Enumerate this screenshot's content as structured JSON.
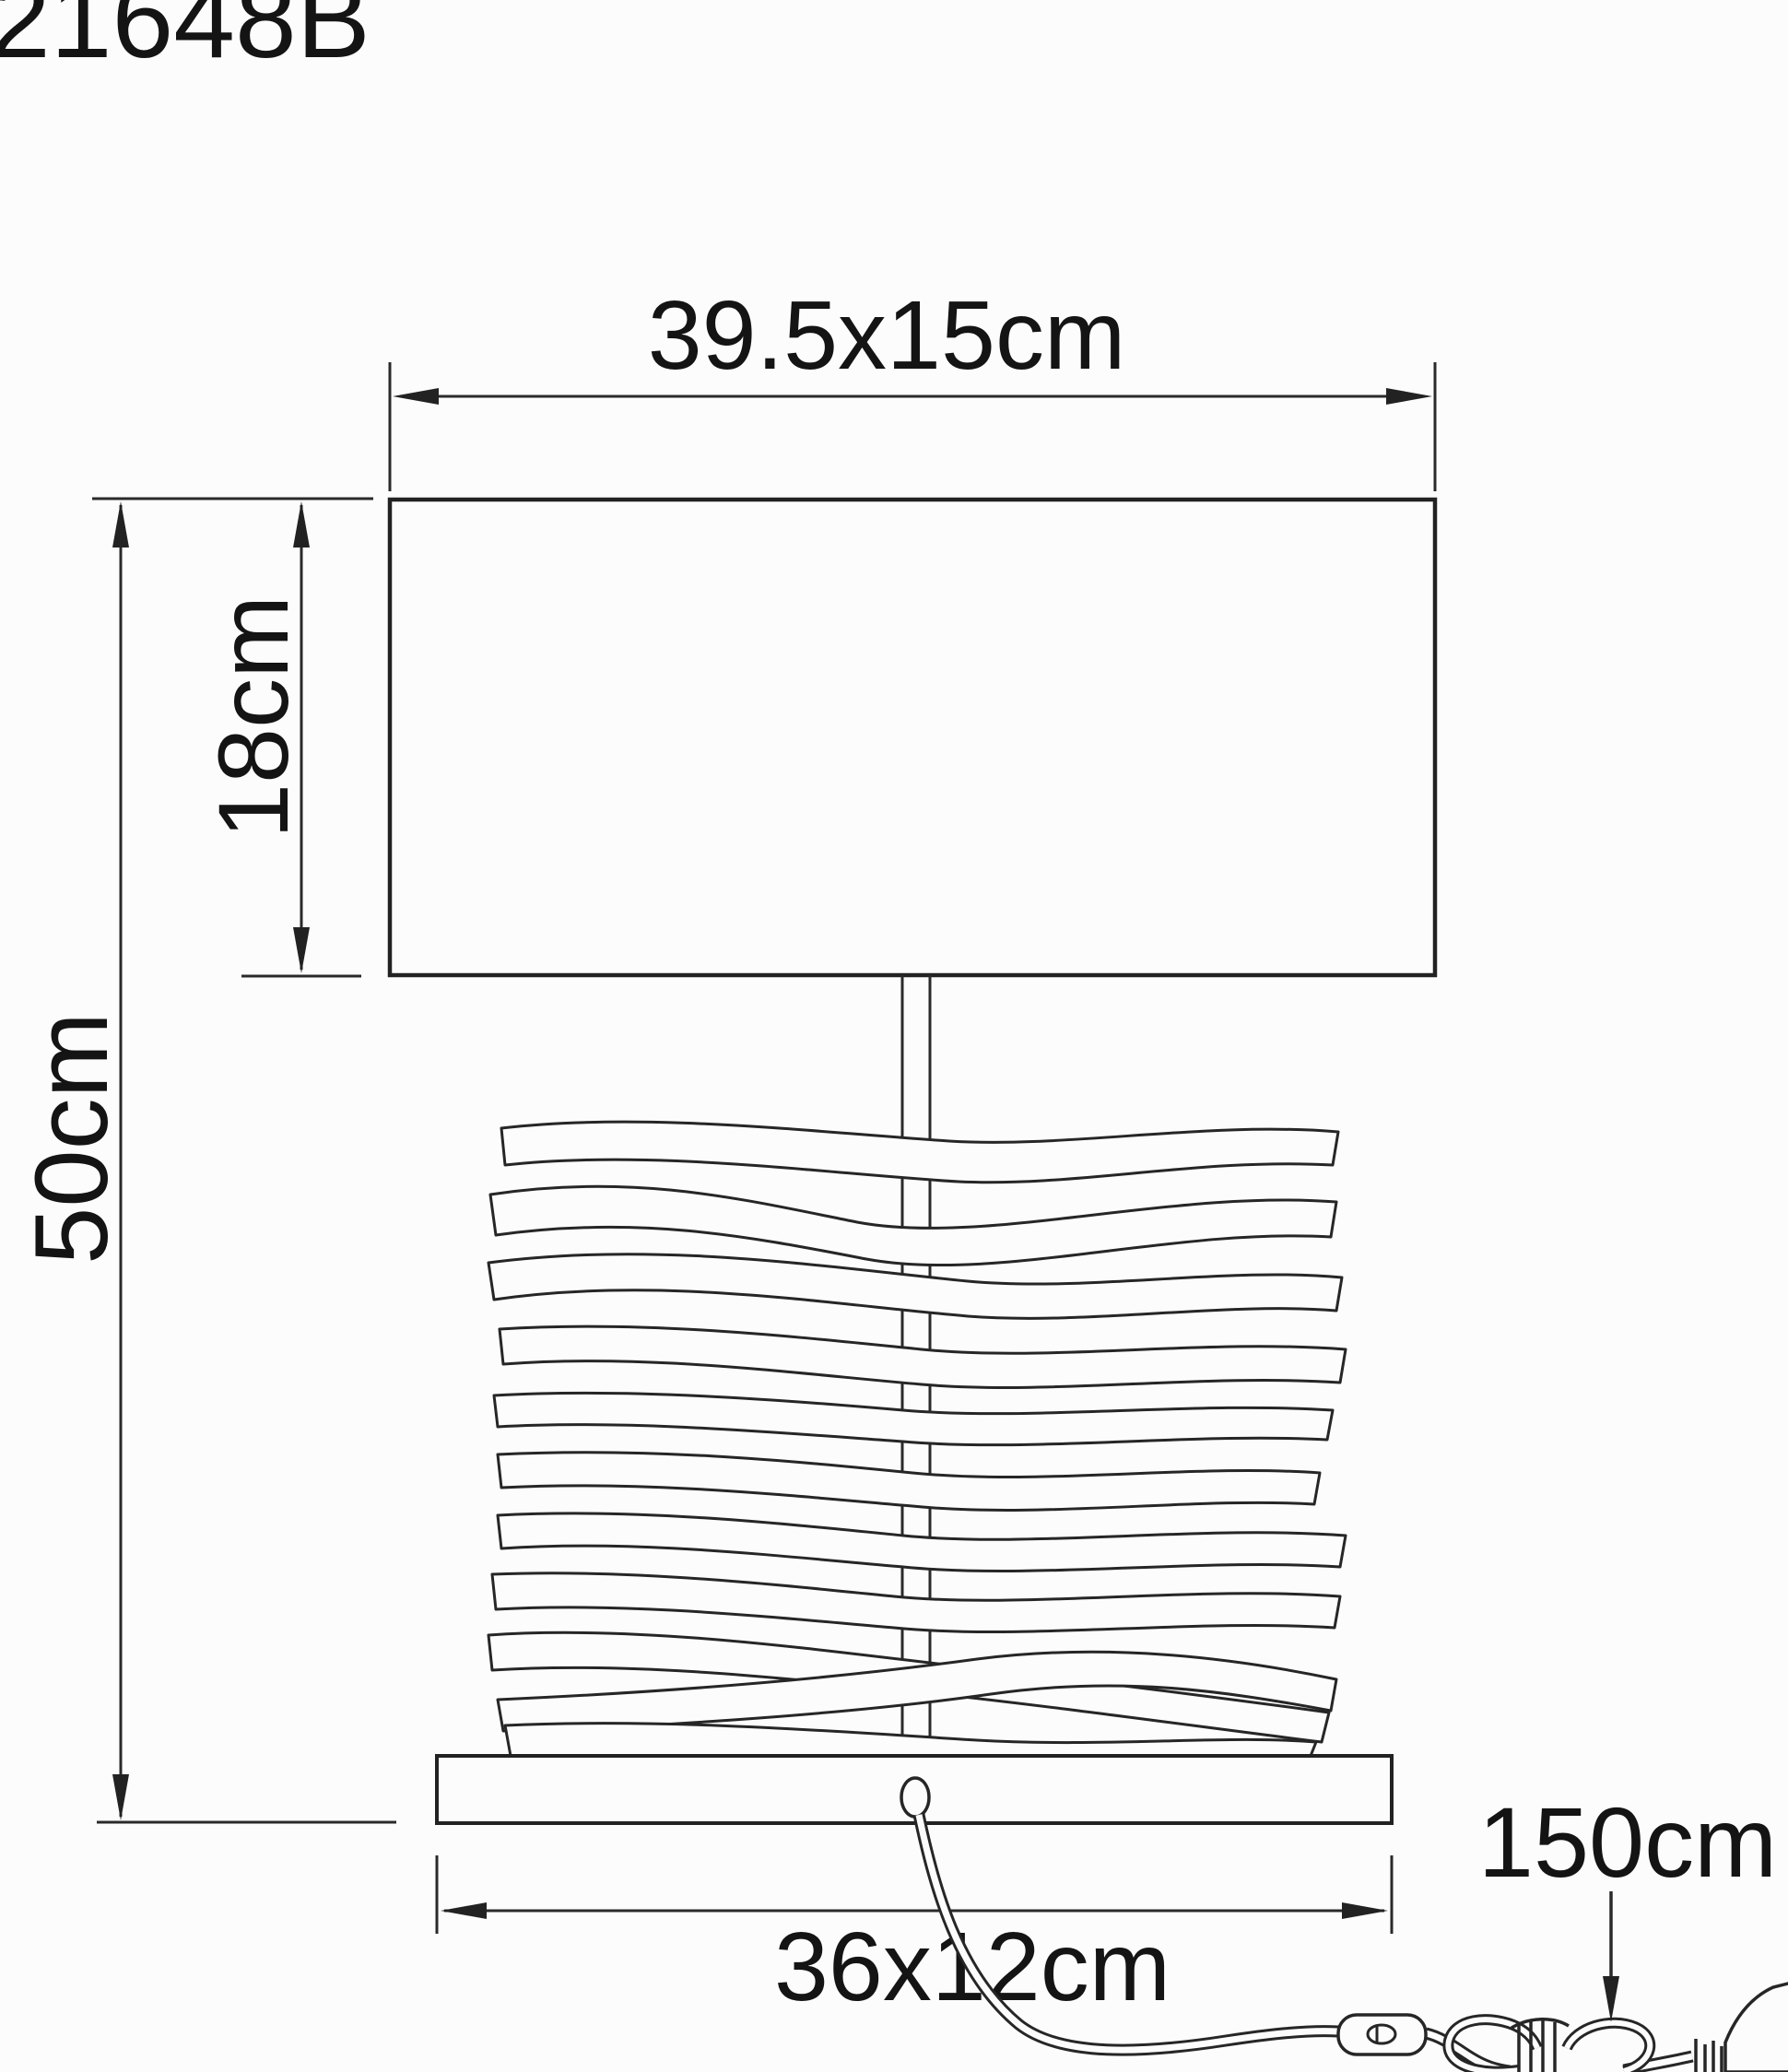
{
  "page": {
    "background": "#fcfcfc",
    "ink_color": "#222222",
    "text_color": "#141414"
  },
  "drawing": {
    "product_code": "21648B",
    "labels": {
      "shade_dimensions": "39.5x15cm",
      "shade_height": "18cm",
      "total_height": "50cm",
      "base_dimensions": "36x12cm",
      "cable_length": "150cm"
    }
  }
}
